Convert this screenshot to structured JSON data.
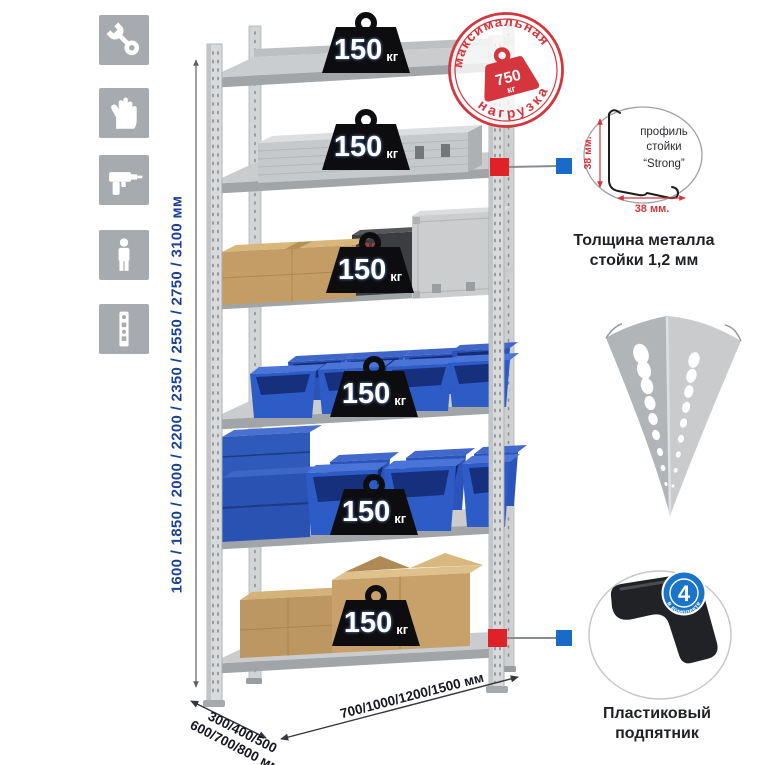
{
  "icon_panel": {
    "tile_color": "#a7abb0",
    "items": [
      {
        "name": "wrench-icon"
      },
      {
        "name": "gloves-icon"
      },
      {
        "name": "drill-icon"
      },
      {
        "name": "person-icon"
      },
      {
        "name": "rack-profile-icon"
      }
    ]
  },
  "rack": {
    "shelf_count": 6,
    "shelf_load": {
      "value": "150",
      "unit": "кг"
    },
    "heights_label": "1600 / 1850 / 2000 / 2200 / 2350 / 2550 / 2750 / 3100 мм",
    "depth_label": {
      "line1": "300/400/500",
      "line2": "600/700/800 мм"
    },
    "width_label": "700/1000/1200/1500 мм"
  },
  "max_load_stamp": {
    "top_text": "максимальная",
    "bottom_text": "нагрузка",
    "value": "750",
    "unit": "кг"
  },
  "profile_detail": {
    "line1": "профиль",
    "line2": "стойки",
    "line3": "“Strong”",
    "vertical_dim": "38 мм.",
    "horizontal_dim": "38 мм.",
    "caption": {
      "line1": "Толщина металла",
      "line2": "стойки 1,2 мм"
    }
  },
  "foot_detail": {
    "badge_value": "4",
    "badge_arc_text": "в комплекте",
    "caption": {
      "line1": "Пластиковый",
      "line2": "подпятник"
    }
  },
  "colors": {
    "stamp_red": "#d5353d",
    "marker_red": "#e02128",
    "marker_blue": "#1a6bc7",
    "bin_blue": "#2c58c0",
    "cardboard_tan": "#c49c65",
    "metal_gray": "#cbcdcf",
    "dimension_text_blue": "#1c4094",
    "dimension_text_dark": "#16171f"
  }
}
